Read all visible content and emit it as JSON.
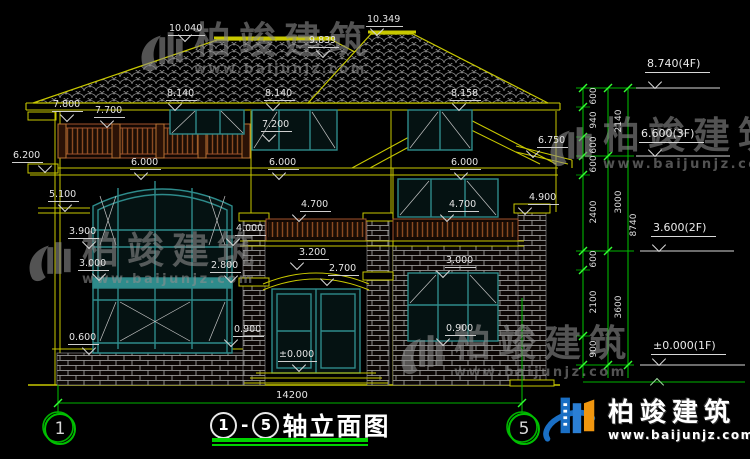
{
  "colors": {
    "line_yellow": "#c8c800",
    "window_teal": "#2e8b8b",
    "railing_brown": "#8a4a22",
    "brick_white": "#b5b5b5",
    "dim_green": "#00b400",
    "tick_green": "#33ff33",
    "text_white": "#e4e4e4",
    "watermark_gray": "#8f8f8f",
    "brand_blue": "#1a6fc4",
    "brand_orange": "#f0960f",
    "background": "#000000"
  },
  "dims": [
    {
      "t": "10.040",
      "x": 168,
      "y": 24
    },
    {
      "t": "9.839",
      "x": 308,
      "y": 36
    },
    {
      "t": "10.349",
      "x": 366,
      "y": 15
    },
    {
      "t": "8.140",
      "x": 166,
      "y": 89
    },
    {
      "t": "8.140",
      "x": 264,
      "y": 89
    },
    {
      "t": "8.158",
      "x": 450,
      "y": 89
    },
    {
      "t": "7.800",
      "x": 52,
      "y": 100
    },
    {
      "t": "7.700",
      "x": 94,
      "y": 106
    },
    {
      "t": "7.200",
      "x": 261,
      "y": 120
    },
    {
      "t": "6.750",
      "x": 537,
      "y": 136
    },
    {
      "t": "6.200",
      "x": 12,
      "y": 151
    },
    {
      "t": "6.000",
      "x": 130,
      "y": 158
    },
    {
      "t": "6.000",
      "x": 268,
      "y": 158
    },
    {
      "t": "6.000",
      "x": 450,
      "y": 158
    },
    {
      "t": "5.100",
      "x": 48,
      "y": 190
    },
    {
      "t": "4.700",
      "x": 300,
      "y": 200
    },
    {
      "t": "4.700",
      "x": 448,
      "y": 200
    },
    {
      "t": "4.900",
      "x": 528,
      "y": 193
    },
    {
      "t": "4.000",
      "x": 235,
      "y": 224
    },
    {
      "t": "3.900",
      "x": 68,
      "y": 227
    },
    {
      "t": "3.200",
      "x": 298,
      "y": 248
    },
    {
      "t": "3.000",
      "x": 78,
      "y": 259
    },
    {
      "t": "3.000",
      "x": 445,
      "y": 256
    },
    {
      "t": "2.800",
      "x": 210,
      "y": 261
    },
    {
      "t": "2.700",
      "x": 328,
      "y": 264
    },
    {
      "t": "0.900",
      "x": 233,
      "y": 325
    },
    {
      "t": "0.900",
      "x": 445,
      "y": 324
    },
    {
      "t": "0.600",
      "x": 68,
      "y": 333
    },
    {
      "t": "±0.000",
      "x": 278,
      "y": 350
    }
  ],
  "tris": [
    {
      "x": 180,
      "y": 30
    },
    {
      "x": 318,
      "y": 46
    },
    {
      "x": 372,
      "y": 24
    },
    {
      "x": 170,
      "y": 99
    },
    {
      "x": 268,
      "y": 99
    },
    {
      "x": 454,
      "y": 99
    },
    {
      "x": 62,
      "y": 110
    },
    {
      "x": 102,
      "y": 116
    },
    {
      "x": 264,
      "y": 130
    },
    {
      "x": 528,
      "y": 146
    },
    {
      "x": 40,
      "y": 161
    },
    {
      "x": 136,
      "y": 168
    },
    {
      "x": 274,
      "y": 168
    },
    {
      "x": 456,
      "y": 168
    },
    {
      "x": 60,
      "y": 200
    },
    {
      "x": 294,
      "y": 210
    },
    {
      "x": 442,
      "y": 210
    },
    {
      "x": 520,
      "y": 203
    },
    {
      "x": 228,
      "y": 234
    },
    {
      "x": 84,
      "y": 237
    },
    {
      "x": 292,
      "y": 258
    },
    {
      "x": 94,
      "y": 269
    },
    {
      "x": 438,
      "y": 266
    },
    {
      "x": 226,
      "y": 271
    },
    {
      "x": 322,
      "y": 274
    },
    {
      "x": 226,
      "y": 335
    },
    {
      "x": 438,
      "y": 334
    },
    {
      "x": 84,
      "y": 343
    },
    {
      "x": 294,
      "y": 360
    },
    {
      "x": 650,
      "y": 77
    },
    {
      "x": 650,
      "y": 145
    },
    {
      "x": 654,
      "y": 240
    },
    {
      "x": 654,
      "y": 354
    }
  ],
  "up_tris": [
    {
      "x": 652,
      "y": 380
    }
  ],
  "levels": [
    {
      "t": "8.740(4F)",
      "x": 645,
      "y": 57
    },
    {
      "t": "6.600(3F)",
      "x": 639,
      "y": 127
    },
    {
      "t": "3.600(2F)",
      "x": 651,
      "y": 221
    },
    {
      "t": "±0.000(1F)",
      "x": 651,
      "y": 339
    }
  ],
  "chain_dims": [
    {
      "t": "600",
      "x": 576,
      "y": 91
    },
    {
      "t": "940",
      "x": 576,
      "y": 115
    },
    {
      "t": "600",
      "x": 576,
      "y": 140
    },
    {
      "t": "600",
      "x": 576,
      "y": 159
    },
    {
      "t": "2400",
      "x": 576,
      "y": 207
    },
    {
      "t": "600",
      "x": 576,
      "y": 254
    },
    {
      "t": "2100",
      "x": 576,
      "y": 297
    },
    {
      "t": "900",
      "x": 576,
      "y": 344
    },
    {
      "t": "2140",
      "x": 601,
      "y": 116
    },
    {
      "t": "3000",
      "x": 601,
      "y": 197
    },
    {
      "t": "3600",
      "x": 601,
      "y": 302
    },
    {
      "t": "8740",
      "x": 616,
      "y": 220
    }
  ],
  "axis": {
    "span_dim": "14200",
    "bubbles": [
      {
        "label": "1",
        "x": 44,
        "y": 413
      },
      {
        "label": "5",
        "x": 508,
        "y": 413
      }
    ]
  },
  "title": {
    "axis_start": "1",
    "dash": "-",
    "axis_end": "5",
    "text": "轴立面图"
  },
  "watermarks": [
    {
      "cn": "柏竣建筑",
      "url": "www.baijunjz.com",
      "x": 136,
      "y": 22
    },
    {
      "cn": "柏竣建筑",
      "url": "www.baijunjz.com",
      "x": 545,
      "y": 117
    },
    {
      "cn": "柏竣建筑",
      "url": "www.baijunjz.com",
      "x": 24,
      "y": 232
    },
    {
      "cn": "柏竣建筑",
      "url": "www.baijunjz.com",
      "x": 396,
      "y": 325
    }
  ],
  "brand": {
    "cn": "柏竣建筑",
    "url": "www.baijunjz.com"
  }
}
